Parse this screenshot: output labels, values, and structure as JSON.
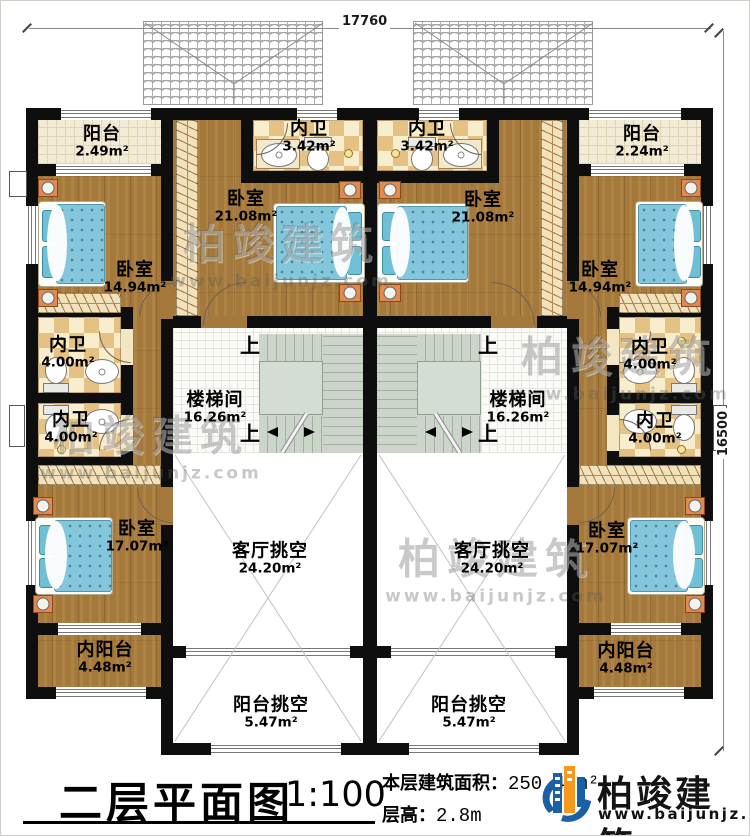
{
  "plan": {
    "dim_top": "17760",
    "dim_right": "16500",
    "up": "上"
  },
  "rooms": [
    {
      "id": "balcony-tl",
      "name": "阳台",
      "area": "2.49m²"
    },
    {
      "id": "bath-tl",
      "name": "内卫",
      "area": "3.42m²"
    },
    {
      "id": "bath-tr",
      "name": "内卫",
      "area": "3.42m²"
    },
    {
      "id": "balcony-tr",
      "name": "阳台",
      "area": "2.24m²"
    },
    {
      "id": "bedroom-left-upper",
      "name": "卧室",
      "area": "14.94m²"
    },
    {
      "id": "bedroom-center-left",
      "name": "卧室",
      "area": "21.08m²"
    },
    {
      "id": "bedroom-center-right",
      "name": "卧室",
      "area": "21.08m²"
    },
    {
      "id": "bedroom-right-upper",
      "name": "卧室",
      "area": "14.94m²"
    },
    {
      "id": "bath-left-1",
      "name": "内卫",
      "area": "4.00m²"
    },
    {
      "id": "bath-left-2",
      "name": "内卫",
      "area": "4.00m²"
    },
    {
      "id": "bath-right-1",
      "name": "内卫",
      "area": "4.00m²"
    },
    {
      "id": "bath-right-2",
      "name": "内卫",
      "area": "4.00m²"
    },
    {
      "id": "stair-left",
      "name": "楼梯间",
      "area": "16.26m²"
    },
    {
      "id": "stair-right",
      "name": "楼梯间",
      "area": "16.26m²"
    },
    {
      "id": "bedroom-left-lower",
      "name": "卧室",
      "area": "17.07m²"
    },
    {
      "id": "bedroom-right-lower",
      "name": "卧室",
      "area": "17.07m²"
    },
    {
      "id": "inner-balcony-left",
      "name": "内阳台",
      "area": "4.48m²"
    },
    {
      "id": "inner-balcony-right",
      "name": "内阳台",
      "area": "4.48m²"
    },
    {
      "id": "living-void-left",
      "name": "客厅挑空",
      "area": "24.20m²"
    },
    {
      "id": "living-void-right",
      "name": "客厅挑空",
      "area": "24.20m²"
    },
    {
      "id": "balcony-void-left",
      "name": "阳台挑空",
      "area": "5.47m²"
    },
    {
      "id": "balcony-void-right",
      "name": "阳台挑空",
      "area": "5.47m²"
    }
  ],
  "titleblock": {
    "title": "二层平面图",
    "scale": "1:100",
    "area_label": "本层建筑面积：",
    "area_value": "250.47m²",
    "floor_height_label": "层高：",
    "floor_height_value": "2.8m",
    "brand": "柏竣建筑",
    "website": "www.baijunjz.com"
  },
  "watermark": {
    "brand": "柏竣建筑",
    "site": "www.baijunjz.com"
  },
  "colors": {
    "logo_blue": "#1b5fa5",
    "logo_orange": "#f6991e",
    "wall": "#0e0e0e",
    "wood": "#a5793b"
  }
}
